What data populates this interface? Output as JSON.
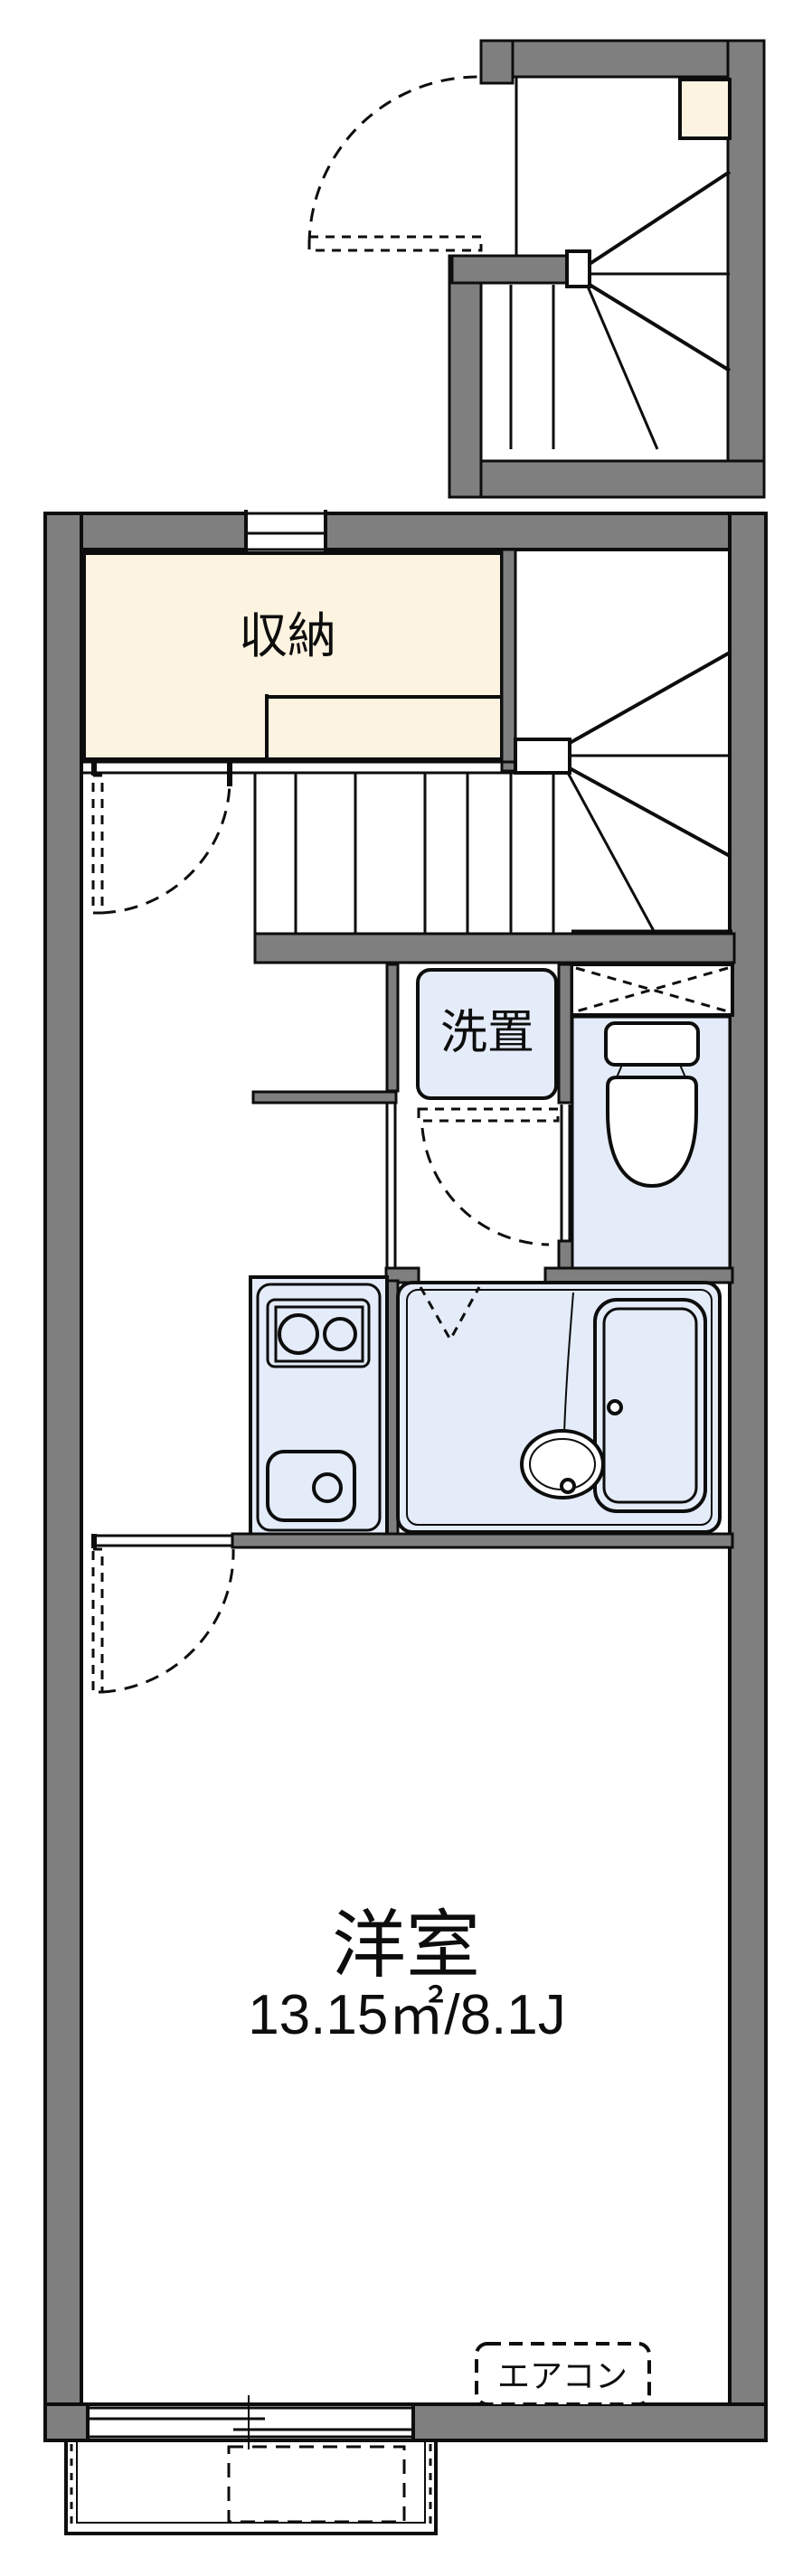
{
  "labels": {
    "closet": "収納",
    "laundry": "洗置",
    "room": "洋室",
    "room_size": "13.15㎡/8.1J",
    "aircon": "エアコン"
  },
  "colors": {
    "wall": "#7f7f7f",
    "line": "#0d0d0d",
    "closet": "#fcf3e0",
    "fixture": "#e4ecf9"
  }
}
